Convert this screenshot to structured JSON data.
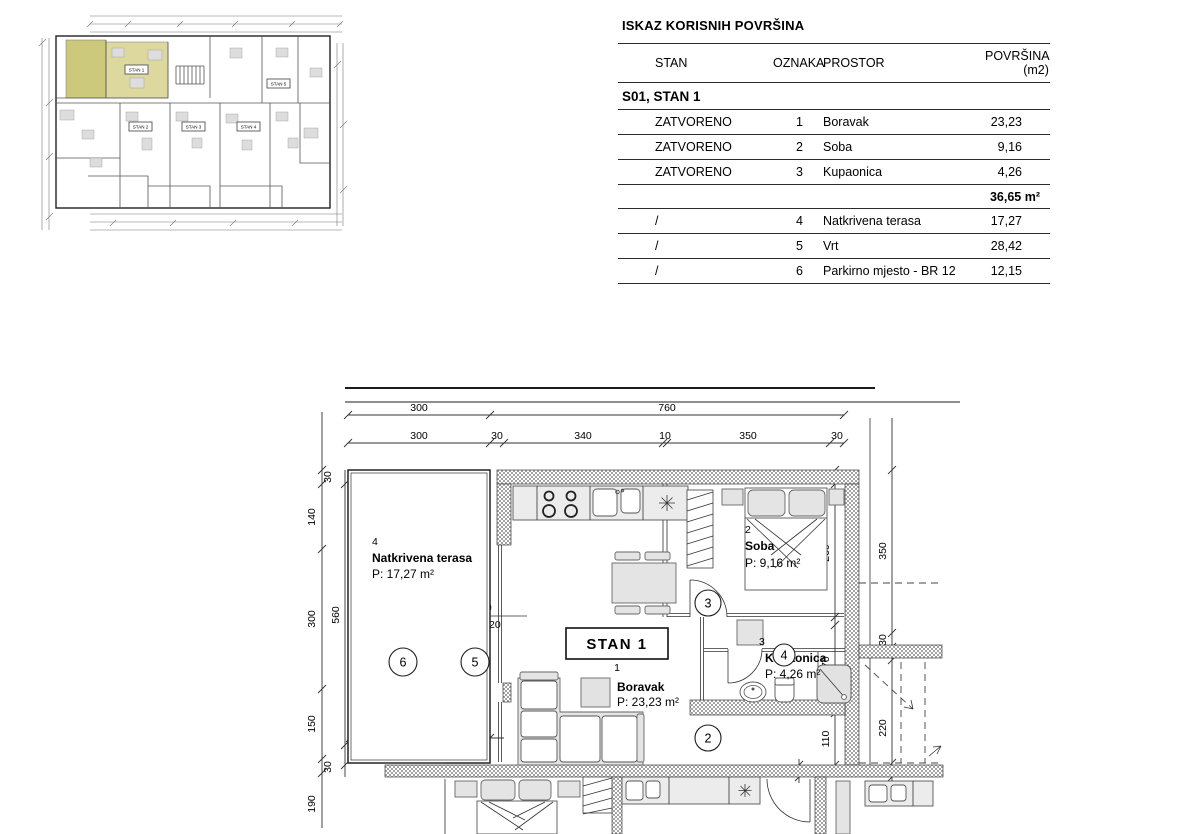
{
  "table": {
    "title": "ISKAZ  KORISNIH POVRŠINA",
    "headers": {
      "stan": "STAN",
      "oznaka": "OZNAKA",
      "prostor": "PROSTOR",
      "povrsina": "POVRŠINA (m2)"
    },
    "section_title": "S01, STAN 1",
    "closed_rows": [
      {
        "stan": "ZATVORENO",
        "oznaka": "1",
        "prostor": "Boravak",
        "povrsina": "23,23"
      },
      {
        "stan": "ZATVORENO",
        "oznaka": "2",
        "prostor": "Soba",
        "povrsina": "9,16"
      },
      {
        "stan": "ZATVORENO",
        "oznaka": "3",
        "prostor": "Kupaonica",
        "povrsina": "4,26"
      }
    ],
    "closed_subtotal": "36,65 m²",
    "open_rows": [
      {
        "stan": "/",
        "oznaka": "4",
        "prostor": "Natkrivena terasa",
        "povrsina": "17,27"
      },
      {
        "stan": "/",
        "oznaka": "5",
        "prostor": "Vrt",
        "povrsina": "28,42"
      },
      {
        "stan": "/",
        "oznaka": "6",
        "prostor": "Parkirno mjesto - BR 12",
        "povrsina": "12,15"
      }
    ]
  },
  "overview": {
    "units": [
      "STAN 1",
      "STAN 2",
      "STAN 3",
      "STAN 4",
      "STAN 5"
    ],
    "highlight": "#dcd89e",
    "highlight_dark": "#ccc87c"
  },
  "plan": {
    "unit_box": "STAN 1",
    "rooms": {
      "boravak": {
        "num": "1",
        "name": "Boravak",
        "area": "P: 23,23 m²"
      },
      "soba": {
        "num": "2",
        "name": "Soba",
        "area": "P: 9,16 m²"
      },
      "kupaonica": {
        "num": "3",
        "name": "Kupaonica",
        "area": "P: 4,26 m²"
      },
      "terasa": {
        "num": "4",
        "name": "Natkrivena terasa",
        "area": "P: 17,27 m²"
      }
    },
    "markers": {
      "living": "2",
      "hall": "3",
      "bath": "4",
      "terrace_right": "5",
      "terrace_left": "6"
    },
    "dims": {
      "top1": [
        "300",
        "760"
      ],
      "top2": [
        "300",
        "30",
        "340",
        "10",
        "350",
        "30"
      ],
      "left_outer": [
        "30",
        "140",
        "300",
        "150",
        "30",
        "190"
      ],
      "left_inner": "560",
      "right_outer": [
        "350",
        "30",
        "220",
        "20"
      ],
      "right_inner": [
        "30",
        "260",
        "170",
        "20",
        "110"
      ],
      "terrace_bottom": [
        "180",
        "120"
      ],
      "door_width": "20",
      "opening": {
        "top": "300",
        "bottom": "220+20"
      }
    }
  }
}
